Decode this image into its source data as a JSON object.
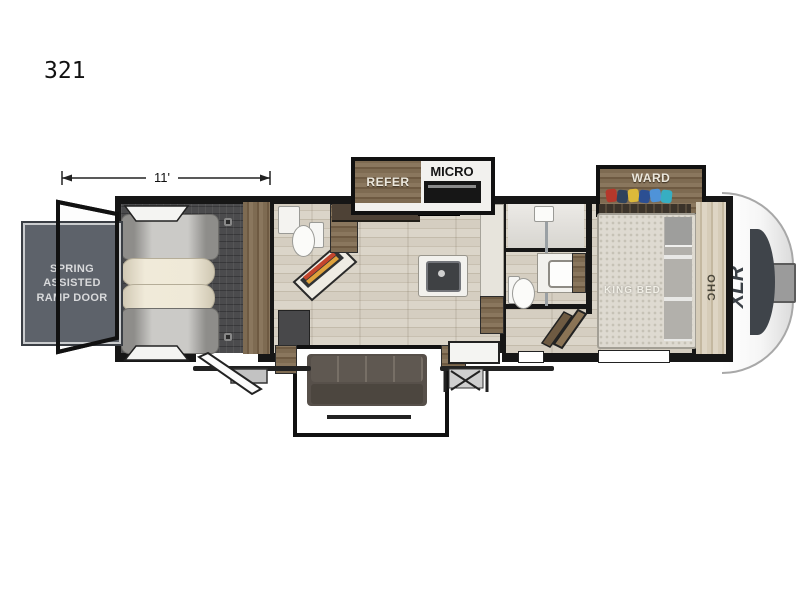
{
  "page": {
    "model_number": "321",
    "dimension": "11'"
  },
  "labels": {
    "ramp_door": "SPRING ASSISTED RAMP DOOR",
    "refrigerator": "REFER",
    "microwave": "MICRO",
    "wardrobe": "WARD",
    "king_bed": "KING BED",
    "overhead_cabinet": "OHC",
    "brand": "XLR"
  },
  "colors": {
    "wall": "#161616",
    "ramp_panel": "#5d626a",
    "wood_cabinet": "#7b6850",
    "light_wood_floor": "#d2cabc",
    "garage_floor": "#4b4b4d",
    "sofa": "#57504a",
    "fireplace_accent": "#c4452c",
    "brand_logo": "#3a4046"
  },
  "clothes_colors": [
    "#b5382b",
    "#30435c",
    "#ddb93a",
    "#2c4f92",
    "#4f93d8",
    "#37aec2"
  ]
}
